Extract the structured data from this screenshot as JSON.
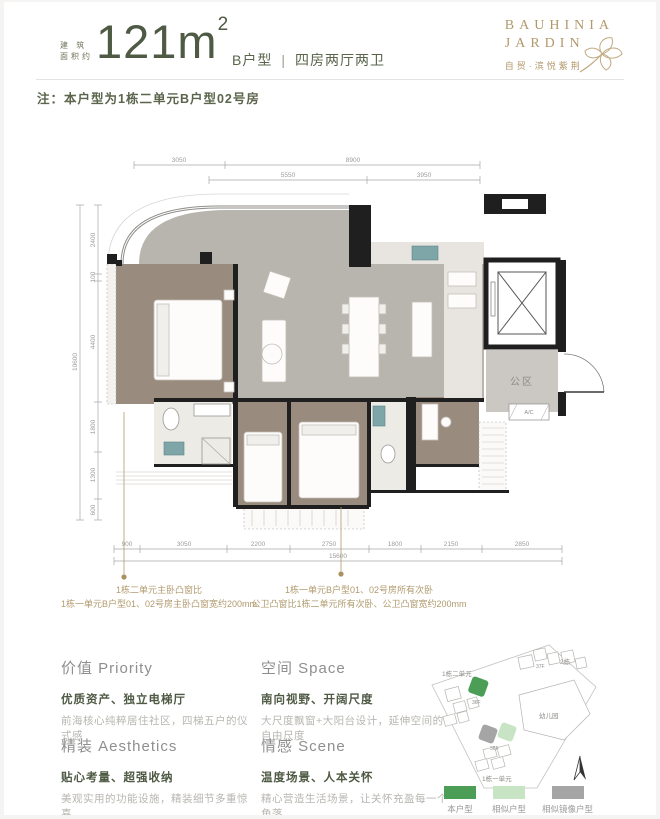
{
  "accent_color": "#4e5a44",
  "gold_color": "#b2996d",
  "header": {
    "area_label_line1": "建 筑",
    "area_label_line2": "面积约",
    "area_value": "121m",
    "area_sup": "2",
    "unit_type": "B户型",
    "separator": "|",
    "layout_desc": "四房两厅两卫",
    "logo": {
      "line1": "BAUHINIA",
      "line2": "JARDIN",
      "subtitle": "自贸·滨悦紫荆"
    }
  },
  "note": "注：本户型为1栋二单元B户型02号房",
  "floorplan": {
    "dims": {
      "top_row1": [
        "3050",
        "8900"
      ],
      "top_row2": [
        "5550",
        "3950"
      ],
      "left": [
        "2400",
        "100",
        "4400",
        "1800",
        "1300",
        "600"
      ],
      "left_overall": "10600",
      "bottom": [
        "900",
        "3050",
        "2200",
        "2750",
        "1800",
        "2150",
        "2850"
      ],
      "bottom_overall": "15600"
    },
    "labels": {
      "public_area": "公区",
      "ac": "A/C"
    },
    "annotations": [
      {
        "line1": "1栋二单元主卧凸窗比",
        "line2": "1栋一单元B户型01、02号房主卧凸窗宽约200mm"
      },
      {
        "line1": "1栋一单元B户型01、02号房所有次卧",
        "line2": "公卫凸窗比1栋二单元所有次卧、公卫凸窗宽约200mm"
      }
    ]
  },
  "sections": [
    {
      "title": "价值 Priority",
      "subtitle": "优质资产、独立电梯厅",
      "body": "前海核心纯粹居住社区，四梯五户的仪式感"
    },
    {
      "title": "空间 Space",
      "subtitle": "南向视野、开阔尺度",
      "body": "大尺度飘窗+大阳台设计，延伸空间的自由尺度"
    },
    {
      "title": "精装 Aesthetics",
      "subtitle": "贴心考量、超强收纳",
      "body": "美观实用的功能设施，精装细节多重惊喜"
    },
    {
      "title": "情感 Scene",
      "subtitle": "温度场景、人本关怀",
      "body": "精心营造生活场景，让关怀充盈每一个角落"
    }
  ],
  "sitemap": {
    "labels": {
      "unit2": "1栋二单元",
      "building2": "2栋",
      "floor_a": "37F",
      "floor_b": "36F",
      "floor_c": "36F",
      "kindergarten": "幼儿园",
      "unit1": "1栋一单元"
    },
    "legend": [
      {
        "label": "本户型",
        "color": "#4c9e57"
      },
      {
        "label": "相似户型",
        "color": "#c7e5c4"
      },
      {
        "label": "相似镜像户型",
        "color": "#a5a5a5"
      }
    ]
  }
}
